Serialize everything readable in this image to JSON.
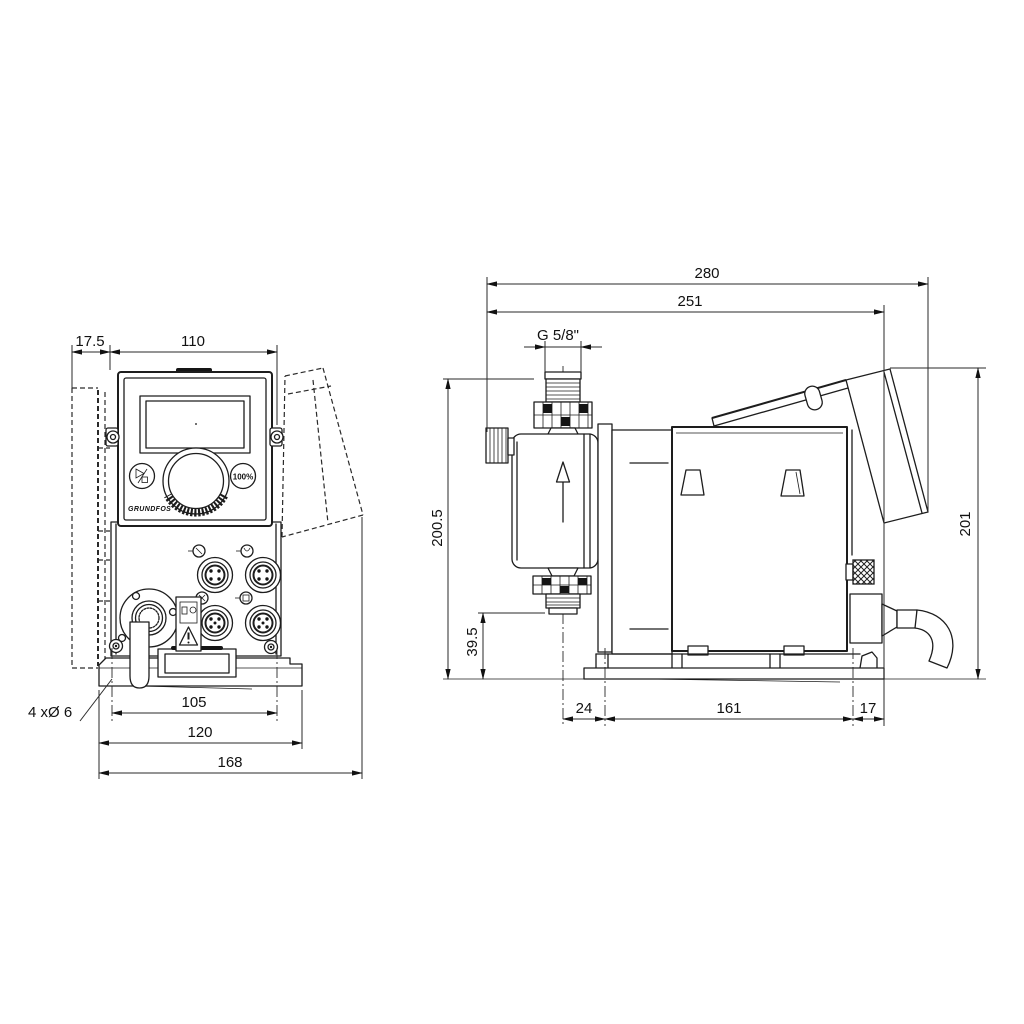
{
  "front_view": {
    "dims": {
      "plate_offset": "17.5",
      "panel_width": "110",
      "hole_callout": "4 xØ 6",
      "hole_spacing": "105",
      "base_width": "120",
      "overall_width": "168"
    },
    "panel": {
      "brand": "GRUNDFOS",
      "capacity_button_label": "100%"
    }
  },
  "side_view": {
    "dims": {
      "overall_depth": "280",
      "body_depth": "251",
      "connection_thread": "G 5/8\"",
      "height_to_connection": "200.5",
      "outlet_height": "39.5",
      "front_offset": "24",
      "foot_hole_spacing": "161",
      "rear_offset": "17",
      "overall_height": "201"
    }
  }
}
